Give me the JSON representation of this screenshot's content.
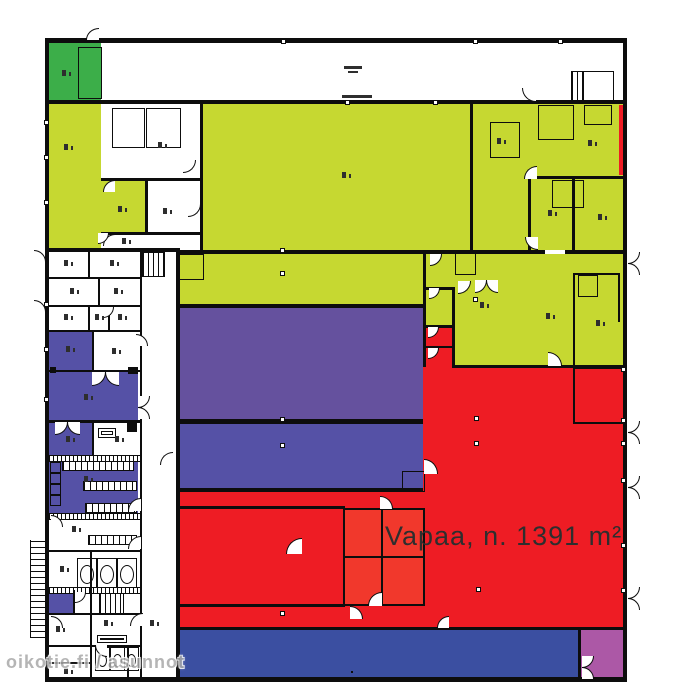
{
  "plan": {
    "vacant_label": "Vapaa, n. 1391 m²",
    "vacant_area_m2": 1391,
    "watermark": "oikotie.fi / asunnot"
  },
  "zones": [
    {
      "name": "vacant-space",
      "color_key": "red"
    },
    {
      "name": "hall-upper",
      "color_key": "chartreuse"
    },
    {
      "name": "entry-room",
      "color_key": "green"
    },
    {
      "name": "mid-hall-upper",
      "color_key": "violet"
    },
    {
      "name": "mid-hall-lower",
      "color_key": "indigo"
    },
    {
      "name": "bottom-strip",
      "color_key": "royal"
    },
    {
      "name": "corner-room",
      "color_key": "magenta"
    }
  ],
  "colors": {
    "wall": "#0d0d0d",
    "paper": "#ffffff",
    "chartreuse": "#c6d831",
    "green": "#3cae49",
    "violet": "#65519e",
    "indigo": "#5551a6",
    "red": "#ee1c24",
    "red_light": "#f1382c",
    "royal": "#3b4fa1",
    "magenta": "#ac58a6",
    "label_ink": "#2e2e2e",
    "watermark_gray": "#a9a9a9"
  }
}
